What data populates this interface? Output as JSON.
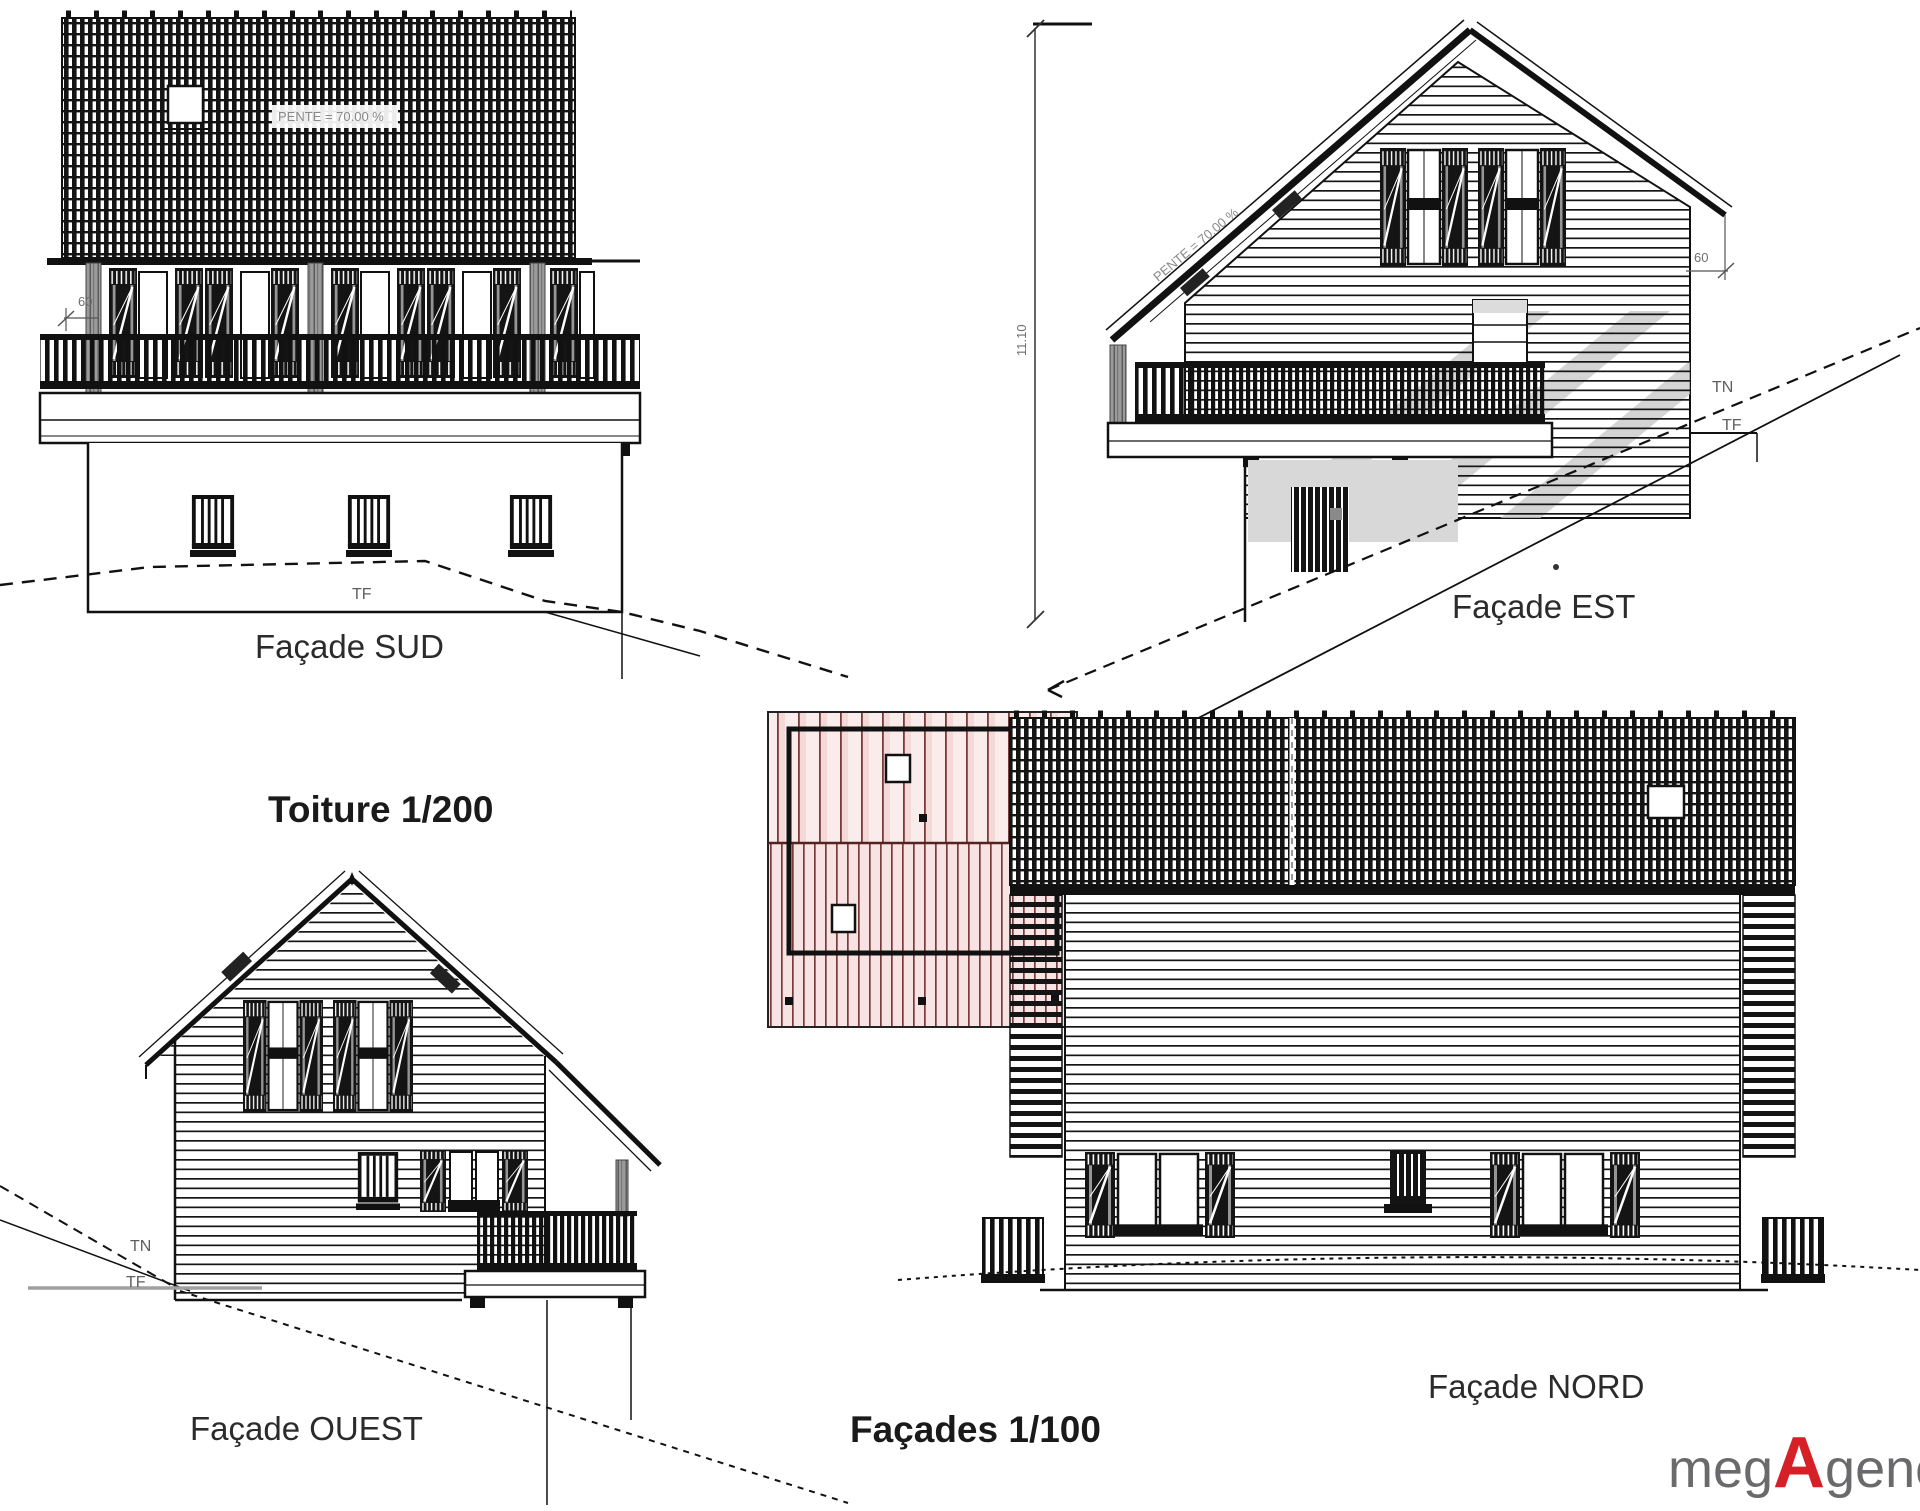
{
  "sheet": {
    "roof_plan_title": "Toiture 1/200",
    "facades_scale_label": "Façades 1/100"
  },
  "facade_sud": {
    "caption": "Façade SUD",
    "roof_slope_label": "PENTE = 70.00 %",
    "eave_dim": "60",
    "finished_ground_label": "TF"
  },
  "facade_est": {
    "caption": "Façade EST",
    "roof_slope_label": "PENTE = 70.00 %",
    "height_dim": "11.10",
    "eave_dim": "60",
    "natural_ground_label": "TN",
    "finished_ground_label": "TF"
  },
  "facade_ouest": {
    "caption": "Façade OUEST",
    "natural_ground_label": "TN",
    "finished_ground_label": "TF"
  },
  "facade_nord": {
    "caption": "Façade NORD"
  },
  "logo": {
    "prefix": "meg",
    "accent": "A",
    "suffix": "gence"
  },
  "colors": {
    "ink": "#1a1a1a",
    "muted_text": "#6e6e6e",
    "roof_plan_line": "#7a3b3b",
    "roof_plan_fill": "#f7e3e3",
    "shadow_gray": "#c9c9c9",
    "basement_gray": "#d8d8d8",
    "logo_gray": "#6a6a6d",
    "logo_red": "#d61f26"
  }
}
